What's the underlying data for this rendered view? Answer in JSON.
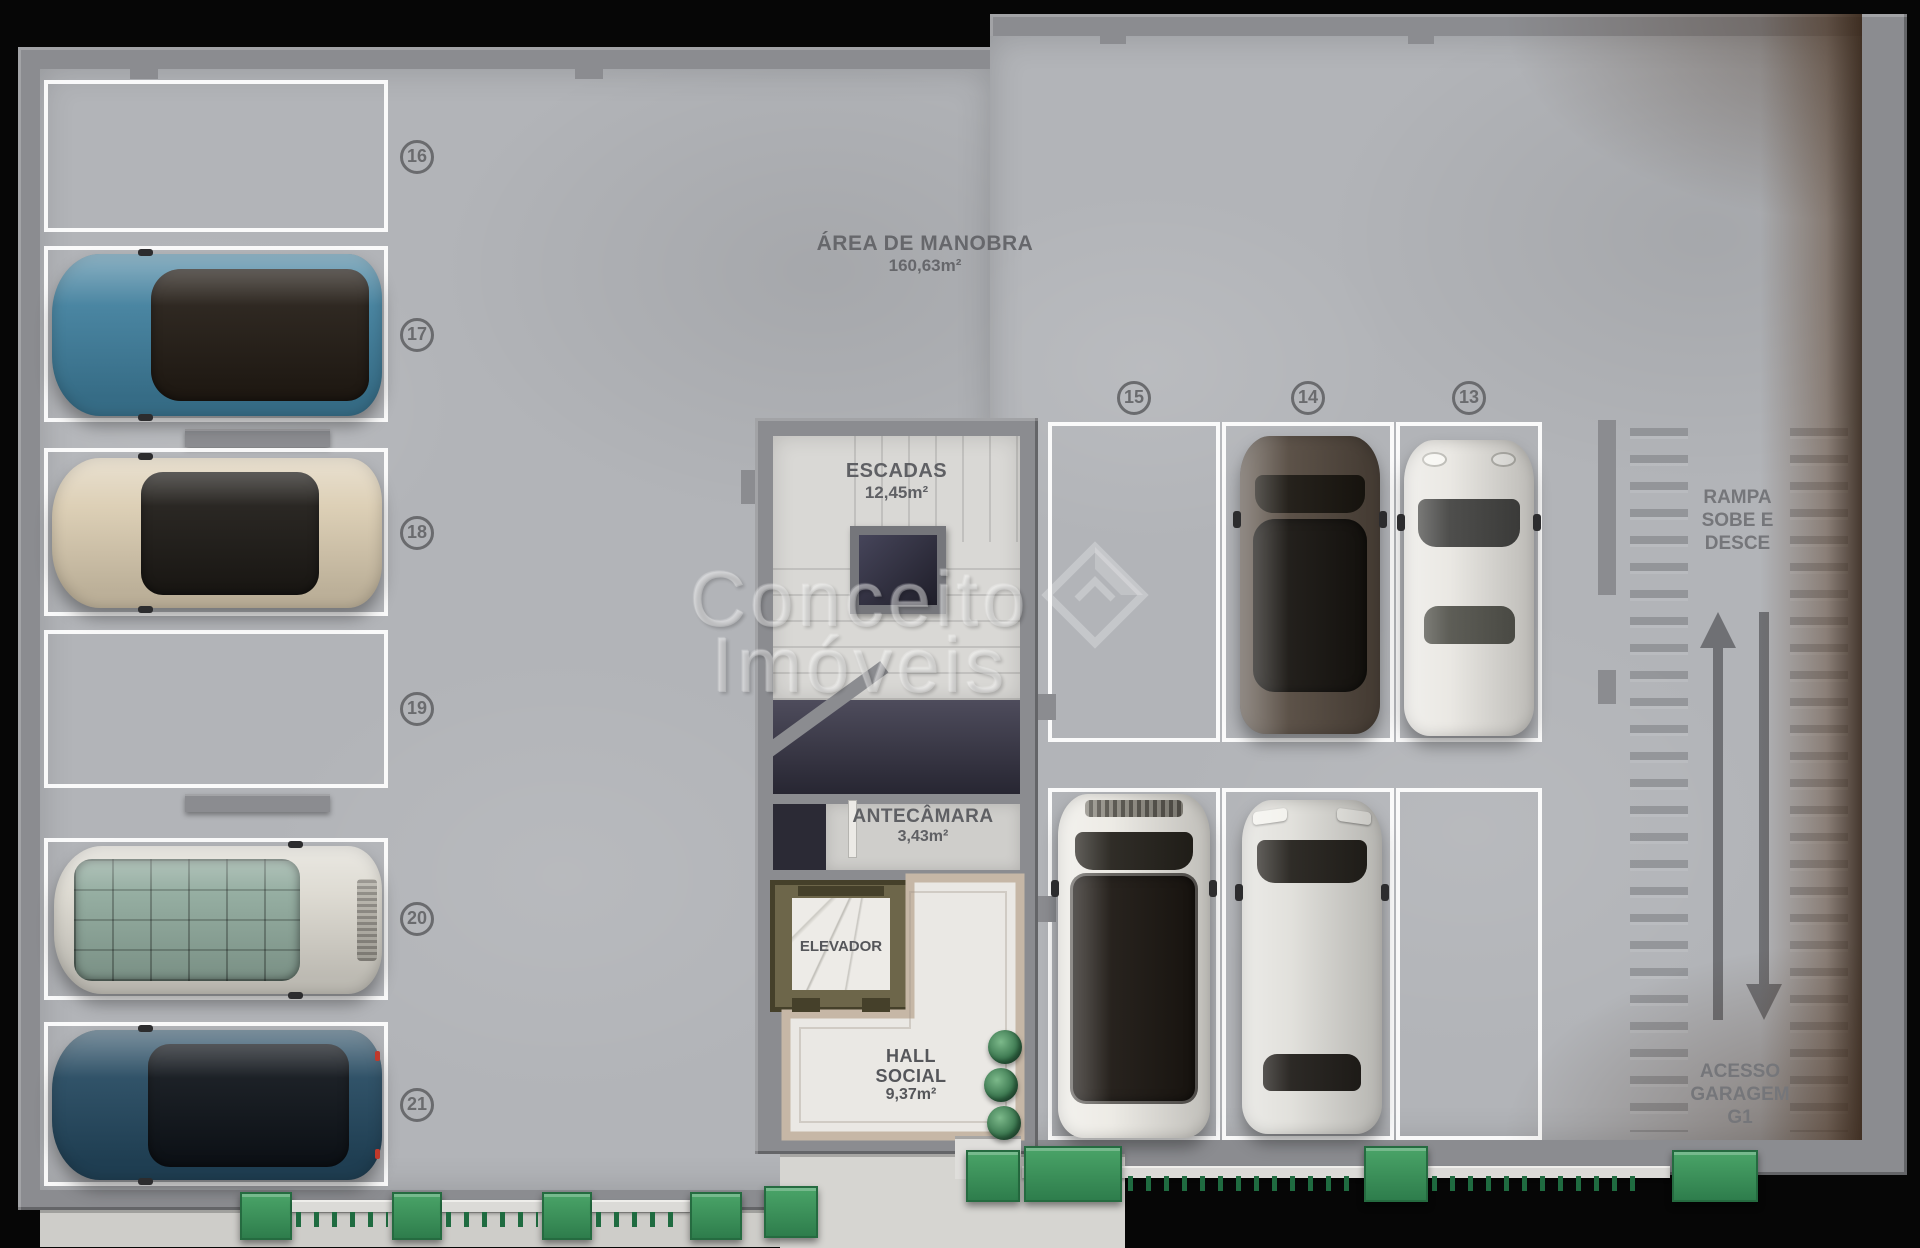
{
  "watermark": {
    "line1": "Conceito",
    "line2": "Imóveis"
  },
  "labels": {
    "maneuver": {
      "title": "ÁREA DE MANOBRA",
      "area": "160,63m²"
    },
    "stairs": {
      "title": "ESCADAS",
      "area": "12,45m²"
    },
    "antechamber": {
      "title": "ANTECÂMARA",
      "area": "3,43m²"
    },
    "elevator": {
      "title": "ELEVADOR"
    },
    "hall": {
      "title1": "HALL",
      "title2": "SOCIAL",
      "area": "9,37m²"
    },
    "ramp": {
      "line1": "RAMPA",
      "line2": "SOBE E",
      "line3": "DESCE"
    },
    "access": {
      "line1": "ACESSO",
      "line2": "GARAGEM",
      "line3": "G1"
    }
  },
  "spots": {
    "left": [
      "16",
      "17",
      "18",
      "19",
      "20",
      "21"
    ],
    "middle_top": [
      "15",
      "14",
      "13"
    ]
  },
  "cars": [
    {
      "spot": "17",
      "body": "#3f7e9c",
      "roof": "#221b14",
      "description": "teal-suv-facing-left"
    },
    {
      "spot": "18",
      "body": "#dbcdb2",
      "roof": "#1d1a16",
      "description": "champagne-sedan-facing-left"
    },
    {
      "spot": "20",
      "body": "#dcd9d0",
      "roof": "#8fa99c",
      "description": "white-suv-green-glass-roof"
    },
    {
      "spot": "21",
      "body": "#24485f",
      "roof": "#0e1319",
      "description": "navy-sedan-facing-left"
    },
    {
      "spot": "14",
      "body": "#54493f",
      "roof": "#171410",
      "description": "dark-gray-car-facing-up"
    },
    {
      "spot": "13",
      "body": "#e9e7e2",
      "roof": "#454543",
      "description": "white-sports-car-facing-up"
    },
    {
      "spot": "15-lower",
      "body": "#eceae4",
      "roof": "#1c1712",
      "description": "white-suv-black-panoramic-roof"
    },
    {
      "spot": "14-lower",
      "body": "#e0dfda",
      "roof": "#211e1a",
      "description": "silver-sedan-facing-up"
    }
  ],
  "colors": {
    "floor": "#b2b4b8",
    "wall": "#8b8c90",
    "marking_white": "#ffffff",
    "planter_green": "#33915c",
    "label_gray": "#5f6064",
    "void_dark": "#2c2b36",
    "elevator_frame": "#6d664a",
    "hall_border_beige": "#c6b7a6"
  }
}
